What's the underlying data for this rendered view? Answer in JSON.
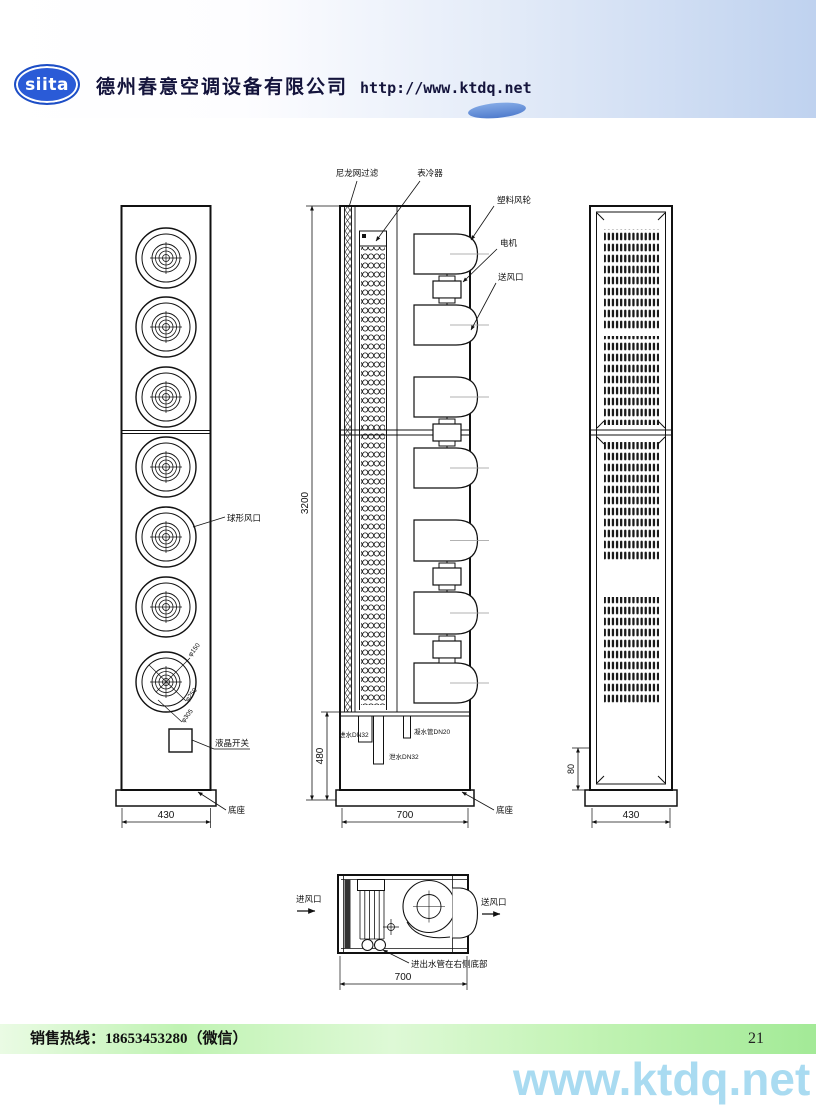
{
  "header": {
    "logo": "siita",
    "company": "德州春意空调设备有限公司",
    "url": "http://www.ktdq.net"
  },
  "front_view": {
    "nozzle_label": "球形风口",
    "dia_labels": [
      "φ150",
      "φ250",
      "φ305"
    ],
    "switch_label": "液晶开关",
    "base_label": "底座",
    "width_dim": "430"
  },
  "section_view": {
    "filter_label": "尼龙网过滤",
    "coil_label": "表冷器",
    "fan_label": "塑料风轮",
    "motor_label": "电机",
    "outlet_label": "送风口",
    "inlet_pipe": "进水DN32",
    "drain_pipe": "泄水DN32",
    "condensate_pipe": "凝水管DN20",
    "base_label": "底座",
    "height_dim": "3200",
    "lower_dim": "480",
    "width_dim": "700"
  },
  "back_view": {
    "base_dim": "80",
    "width_dim": "430"
  },
  "top_view": {
    "inlet_label": "进风口",
    "outlet_label": "送风口",
    "pipe_note": "进出水管在右侧底部",
    "width_dim": "700"
  },
  "footer": {
    "hotline": "销售热线：18653453280（微信）",
    "page_number": "21",
    "watermark": "www.ktdq.net"
  }
}
